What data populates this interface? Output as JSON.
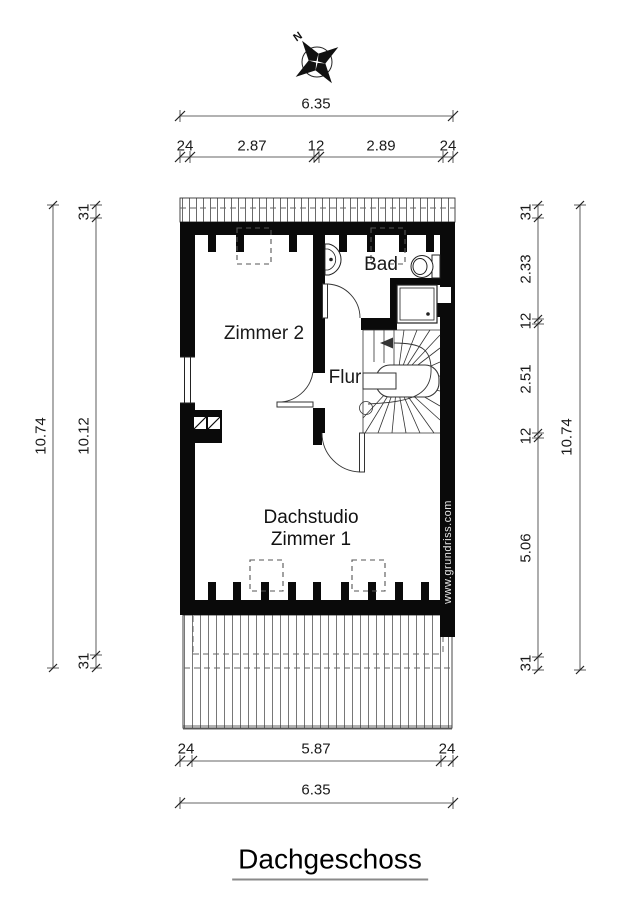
{
  "title": "Dachgeschoss",
  "compass": {
    "north_label": "N"
  },
  "watermark": "www.grundriss.com",
  "rooms": {
    "zimmer2": "Zimmer 2",
    "bad": "Bad",
    "flur": "Flur",
    "dachstudio_line1": "Dachstudio",
    "dachstudio_line2": "Zimmer 1"
  },
  "dimensions": {
    "top": {
      "overall": "6.35",
      "segments": [
        "24",
        "2.87",
        "12",
        "2.89",
        "24"
      ]
    },
    "bottom": {
      "overall": "6.35",
      "segments": [
        "24",
        "5.87",
        "24"
      ]
    },
    "left": {
      "overall": "10.74",
      "segments": [
        "31",
        "10.12",
        "31"
      ]
    },
    "right": {
      "overall": "10.74",
      "segments": [
        "31",
        "2.33",
        "12",
        "2.51",
        "12",
        "5.06",
        "31"
      ]
    }
  }
}
